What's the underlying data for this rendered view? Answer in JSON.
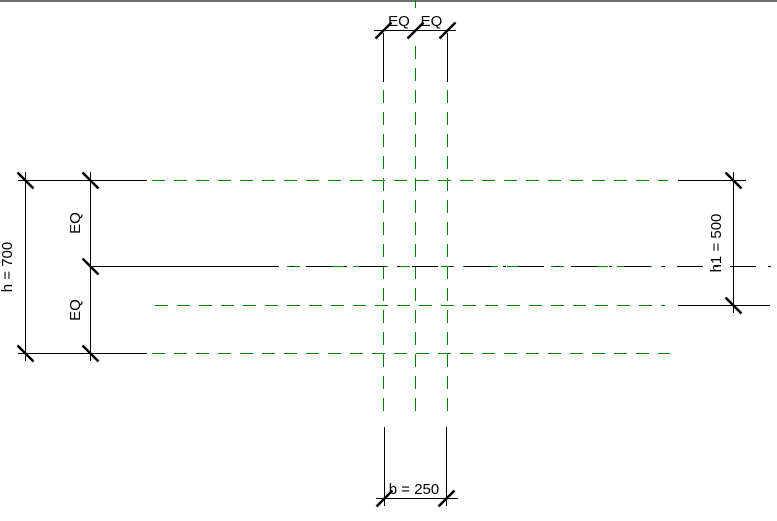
{
  "canvas": {
    "width": 777,
    "height": 521
  },
  "colors": {
    "background": "#ffffff",
    "drawing": "#000000",
    "reference_plane": "#008000",
    "viewport_border": "#6e6e6e"
  },
  "dimensions": {
    "top_width": {
      "segment_labels": [
        "EQ",
        "EQ"
      ]
    },
    "height_overall": {
      "label": "h = 700"
    },
    "height_segments": {
      "segment_labels": [
        "EQ",
        "EQ"
      ]
    },
    "height_right": {
      "label": "h1 = 500"
    },
    "width_bottom": {
      "label": "b = 250"
    }
  }
}
